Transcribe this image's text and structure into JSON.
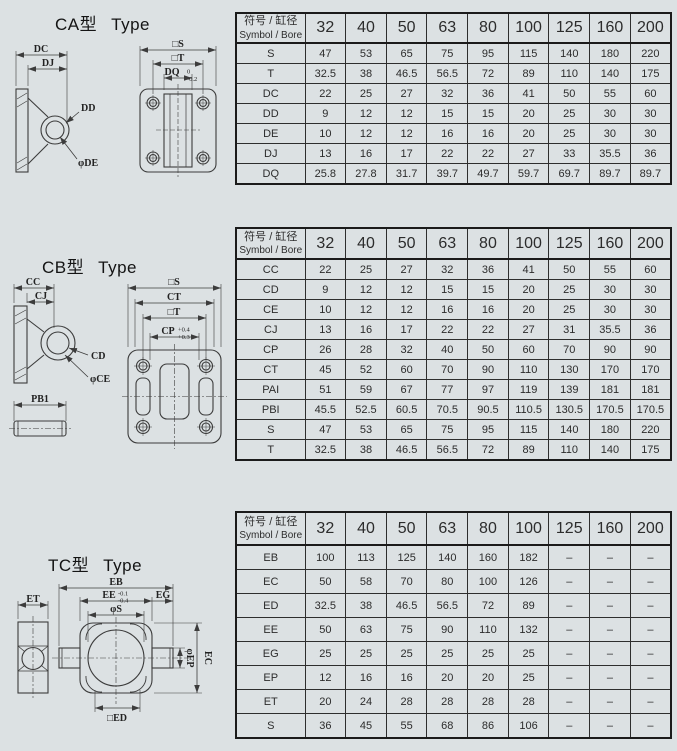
{
  "page": {
    "background": "#dce1e3",
    "line_color": "#3c3c3c",
    "table_border": "#1b1b1b"
  },
  "sections": [
    {
      "title_cn": "CA型",
      "title_en": "Type",
      "drawing": {
        "labels": {
          "dc": "DC",
          "dj": "DJ",
          "dd": "DD",
          "de": "φDE",
          "s": "□S",
          "t": "□T",
          "dq": "DQ",
          "dq_tol_upper": "0",
          "dq_tol_lower": "-0.2"
        }
      },
      "table": {
        "header_cn": "符号 / 缸径",
        "header_en": "Symbol / Bore",
        "bores": [
          "32",
          "40",
          "50",
          "63",
          "80",
          "100",
          "125",
          "160",
          "200"
        ],
        "rows": [
          {
            "symbol": "S",
            "values": [
              "47",
              "53",
              "65",
              "75",
              "95",
              "115",
              "140",
              "180",
              "220"
            ]
          },
          {
            "symbol": "T",
            "values": [
              "32.5",
              "38",
              "46.5",
              "56.5",
              "72",
              "89",
              "110",
              "140",
              "175"
            ]
          },
          {
            "symbol": "DC",
            "values": [
              "22",
              "25",
              "27",
              "32",
              "36",
              "41",
              "50",
              "55",
              "60"
            ]
          },
          {
            "symbol": "DD",
            "values": [
              "9",
              "12",
              "12",
              "15",
              "15",
              "20",
              "25",
              "30",
              "30"
            ]
          },
          {
            "symbol": "DE",
            "values": [
              "10",
              "12",
              "12",
              "16",
              "16",
              "20",
              "25",
              "30",
              "30"
            ]
          },
          {
            "symbol": "DJ",
            "values": [
              "13",
              "16",
              "17",
              "22",
              "22",
              "27",
              "33",
              "35.5",
              "36"
            ]
          },
          {
            "symbol": "DQ",
            "values": [
              "25.8",
              "27.8",
              "31.7",
              "39.7",
              "49.7",
              "59.7",
              "69.7",
              "89.7",
              "89.7"
            ]
          }
        ]
      }
    },
    {
      "title_cn": "CB型",
      "title_en": "Type",
      "drawing": {
        "labels": {
          "cc": "CC",
          "cj": "CJ",
          "cd": "CD",
          "ce": "φCE",
          "pb1": "PB1",
          "s": "□S",
          "ct": "CT",
          "t": "□T",
          "cp": "CP",
          "cp_tol_upper": "+0.4",
          "cp_tol_lower": "+0.3"
        }
      },
      "table": {
        "header_cn": "符号 / 缸径",
        "header_en": "Symbol / Bore",
        "bores": [
          "32",
          "40",
          "50",
          "63",
          "80",
          "100",
          "125",
          "160",
          "200"
        ],
        "rows": [
          {
            "symbol": "CC",
            "values": [
              "22",
              "25",
              "27",
              "32",
              "36",
              "41",
              "50",
              "55",
              "60"
            ]
          },
          {
            "symbol": "CD",
            "values": [
              "9",
              "12",
              "12",
              "15",
              "15",
              "20",
              "25",
              "30",
              "30"
            ]
          },
          {
            "symbol": "CE",
            "values": [
              "10",
              "12",
              "12",
              "16",
              "16",
              "20",
              "25",
              "30",
              "30"
            ]
          },
          {
            "symbol": "CJ",
            "values": [
              "13",
              "16",
              "17",
              "22",
              "22",
              "27",
              "31",
              "35.5",
              "36"
            ]
          },
          {
            "symbol": "CP",
            "values": [
              "26",
              "28",
              "32",
              "40",
              "50",
              "60",
              "70",
              "90",
              "90"
            ]
          },
          {
            "symbol": "CT",
            "values": [
              "45",
              "52",
              "60",
              "70",
              "90",
              "110",
              "130",
              "170",
              "170"
            ]
          },
          {
            "symbol": "PAI",
            "values": [
              "51",
              "59",
              "67",
              "77",
              "97",
              "119",
              "139",
              "181",
              "181"
            ]
          },
          {
            "symbol": "PBI",
            "values": [
              "45.5",
              "52.5",
              "60.5",
              "70.5",
              "90.5",
              "110.5",
              "130.5",
              "170.5",
              "170.5"
            ]
          },
          {
            "symbol": "S",
            "values": [
              "47",
              "53",
              "65",
              "75",
              "95",
              "115",
              "140",
              "180",
              "220"
            ]
          },
          {
            "symbol": "T",
            "values": [
              "32.5",
              "38",
              "46.5",
              "56.5",
              "72",
              "89",
              "110",
              "140",
              "175"
            ]
          }
        ]
      }
    },
    {
      "title_cn": "TC型",
      "title_en": "Type",
      "drawing": {
        "labels": {
          "et": "ET",
          "eb": "EB",
          "ee": "EE",
          "ee_tol_upper": "-0.1",
          "ee_tol_lower": "-0.4",
          "eg": "EG",
          "s": "φS",
          "ep": "φEP",
          "ec": "EC",
          "ed": "□ED"
        }
      },
      "table": {
        "header_cn": "符号 / 缸径",
        "header_en": "Symbol / Bore",
        "bores": [
          "32",
          "40",
          "50",
          "63",
          "80",
          "100",
          "125",
          "160",
          "200"
        ],
        "rows": [
          {
            "symbol": "EB",
            "values": [
              "100",
              "113",
              "125",
              "140",
              "160",
              "182",
              "–",
              "–",
              "–"
            ]
          },
          {
            "symbol": "EC",
            "values": [
              "50",
              "58",
              "70",
              "80",
              "100",
              "126",
              "–",
              "–",
              "–"
            ]
          },
          {
            "symbol": "ED",
            "values": [
              "32.5",
              "38",
              "46.5",
              "56.5",
              "72",
              "89",
              "–",
              "–",
              "–"
            ]
          },
          {
            "symbol": "EE",
            "values": [
              "50",
              "63",
              "75",
              "90",
              "110",
              "132",
              "–",
              "–",
              "–"
            ]
          },
          {
            "symbol": "EG",
            "values": [
              "25",
              "25",
              "25",
              "25",
              "25",
              "25",
              "–",
              "–",
              "–"
            ]
          },
          {
            "symbol": "EP",
            "values": [
              "12",
              "16",
              "16",
              "20",
              "20",
              "25",
              "–",
              "–",
              "–"
            ]
          },
          {
            "symbol": "ET",
            "values": [
              "20",
              "24",
              "28",
              "28",
              "28",
              "28",
              "–",
              "–",
              "–"
            ]
          },
          {
            "symbol": "S",
            "values": [
              "36",
              "45",
              "55",
              "68",
              "86",
              "106",
              "–",
              "–",
              "–"
            ]
          }
        ]
      }
    }
  ]
}
